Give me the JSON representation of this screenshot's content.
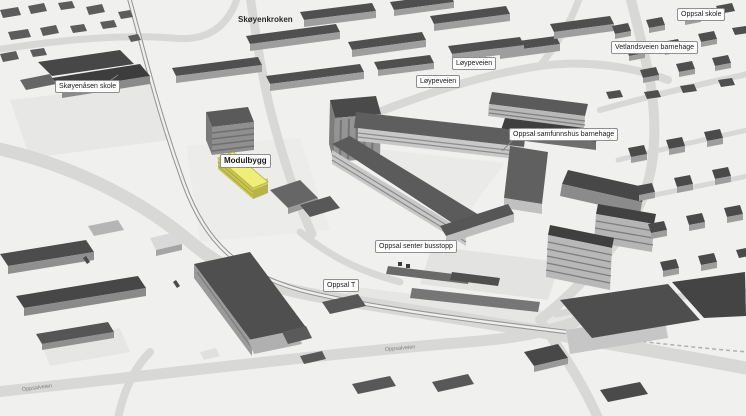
{
  "map": {
    "labels": {
      "skoyenkroken": "Skøyenkroken",
      "skoyenasen_skole": "Skøyenåsen skole",
      "oppsal_skole": "Oppsal skole",
      "vetlandsveien_barnehage": "Vetlandsveien barnehage",
      "loypeveien_upper": "Løypeveien",
      "loypeveien_lower": "Løypeveien",
      "oppsal_samfunnshus_barnehage": "Oppsal samfunnshus barnehage",
      "modulbygg": "Modulbygg",
      "oppsal_senter_busstopp": "Oppsal senter busstopp",
      "oppsal_t": "Oppsal T"
    },
    "road_labels": {
      "oppsalveien_left": "Oppsalveien",
      "oppsalveien_center": "Oppsalveien"
    },
    "highlight": {
      "name": "Modulbygg",
      "roof_color": "#f0ee7a",
      "side_color": "#d6d35c"
    },
    "colors": {
      "background": "#f0f0ef",
      "road": "#d8d8d7",
      "roof_dark": "#4e4e4e",
      "wall_gray": "#a3a3a3",
      "label_bg": "#ffffff",
      "label_border": "#8f8f8f",
      "rail": "#969696"
    }
  }
}
